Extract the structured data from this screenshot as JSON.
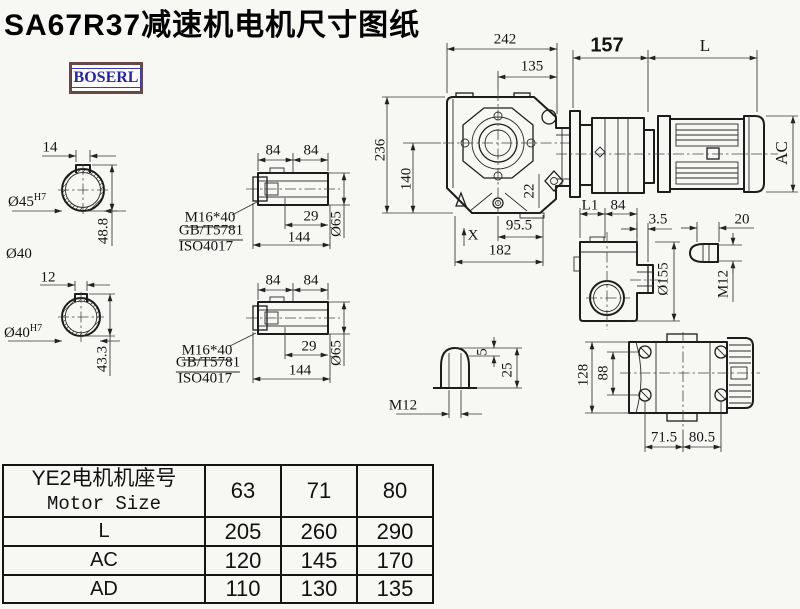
{
  "title": "SA67R37减速机电机尺寸图纸",
  "brand": {
    "logo_text": "BOSERL"
  },
  "shaft_a": {
    "keyway_width": "14",
    "bore_dia": "Ø45",
    "bore_fit": "H7",
    "keyway_depth_dim": "48.8",
    "shaft_dia_label": "Ø40"
  },
  "shaft_b": {
    "keyway_width": "12",
    "bore_dia": "Ø40",
    "bore_fit": "H7",
    "keyway_depth_dim": "43.3"
  },
  "sleeve_a": {
    "seg1": "84",
    "seg2": "84",
    "thread_spec": "M16*40",
    "std_gb": "GB/T5781",
    "std_iso": "ISO4017",
    "engage_depth": "29",
    "length": "144",
    "dia": "Ø65"
  },
  "sleeve_b": {
    "seg1": "84",
    "seg2": "84",
    "thread_spec": "M16*40",
    "std_gb": "GB/T5781",
    "std_iso": "ISO4017",
    "engage_depth": "29",
    "length": "144",
    "dia": "Ø65"
  },
  "front_view": {
    "width": "242",
    "bolt_offset": "135",
    "height": "236",
    "center_height": "140",
    "plug_dim": "22",
    "center_to_edge": "95.5",
    "x_mark": "X",
    "base_width": "182"
  },
  "motor_view": {
    "adapter_len": "157",
    "motor_len": "L",
    "motor_dia": "AC"
  },
  "side_view": {
    "dim_l1": "L1",
    "dim_84": "84",
    "dim_gap": "3.5",
    "flange_dia": "Ø155",
    "dim_20": "20",
    "thread": "M12"
  },
  "plug_detail": {
    "tip_h": "5",
    "total_h": "25",
    "thread": "M12"
  },
  "rear_view": {
    "height": "128",
    "inner_height": "88",
    "span_left": "71.5",
    "span_right": "80.5"
  },
  "table": {
    "header_cn": "YE2电机机座号",
    "header_en": "Motor Size",
    "sizes": [
      "63",
      "71",
      "80"
    ],
    "rows": [
      {
        "label": "L",
        "values": [
          "205",
          "260",
          "290"
        ]
      },
      {
        "label": "AC",
        "values": [
          "120",
          "145",
          "170"
        ]
      },
      {
        "label": "AD",
        "values": [
          "110",
          "130",
          "135"
        ]
      }
    ]
  }
}
